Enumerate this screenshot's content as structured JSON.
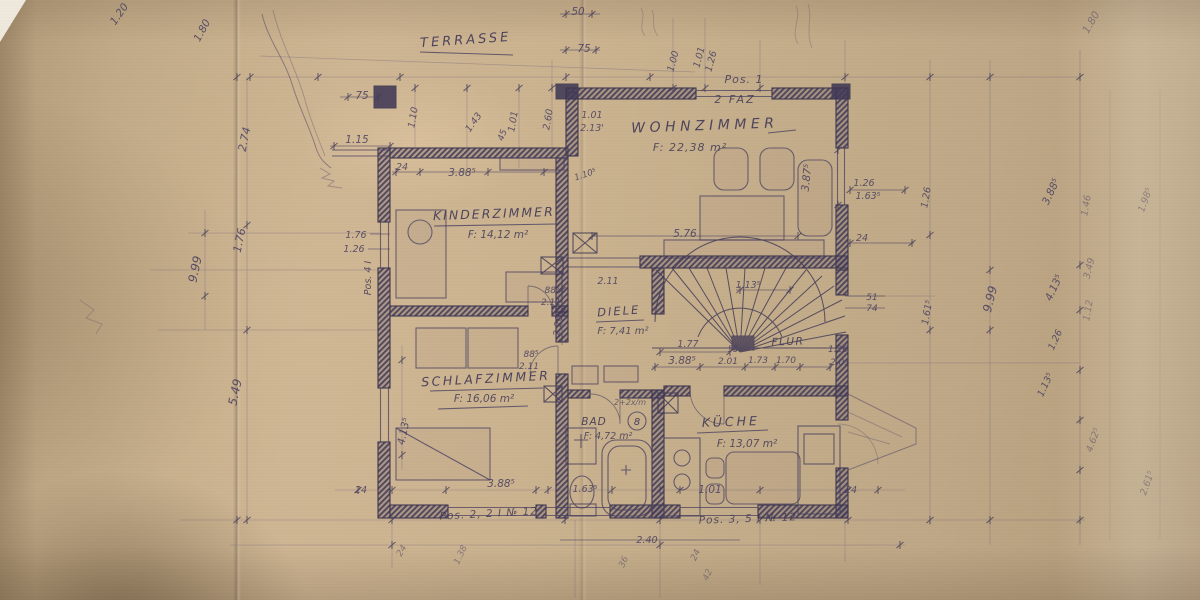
{
  "colors": {
    "paper": "#c8b190",
    "ink": "#4a4160",
    "pencil": "#6d5f80"
  },
  "rooms": {
    "terrasse": {
      "label": "TERRASSE"
    },
    "wohnzimmer": {
      "label": "WOHNZIMMER",
      "area": "F: 22,38 m²"
    },
    "kinderzimmer": {
      "label": "KINDERZIMMER",
      "area": "F: 14,12 m²"
    },
    "schlafzimmer": {
      "label": "SCHLAFZIMMER",
      "area": "F: 16,06 m²"
    },
    "diele": {
      "label": "DIELE",
      "area": "F: 7,41 m²"
    },
    "flur": {
      "label": "FLUR"
    },
    "bad": {
      "label": "BAD",
      "area": "F: 4,72 m²"
    },
    "kueche": {
      "label": "KÜCHE",
      "area": "F: 13,07 m²"
    }
  },
  "badges": {
    "bad_circle": "8"
  },
  "annotations": [
    {
      "t": "Pos. 1",
      "x": 744,
      "y": 83,
      "s": 11,
      "w": 1,
      "cls": "note"
    },
    {
      "t": "2 FAZ",
      "x": 735,
      "y": 103,
      "s": 11,
      "w": 2,
      "cls": "note"
    },
    {
      "t": "Pos. 2, 2 I № 12",
      "x": 489,
      "y": 517,
      "s": 10.5,
      "w": 1,
      "r": -3,
      "cls": "note"
    },
    {
      "t": "Pos. 3, 5 I № 12",
      "x": 748,
      "y": 522,
      "s": 10.5,
      "w": 1,
      "r": -2,
      "cls": "note"
    },
    {
      "t": "Pos. 4 I",
      "x": 371,
      "y": 278,
      "r": -90,
      "s": 9.5,
      "cls": "note"
    },
    {
      "t": "2+2x/m",
      "x": 630,
      "y": 405,
      "s": 8,
      "o": 0.7,
      "cls": "note"
    },
    {
      "t": "1.20",
      "x": 122,
      "y": 16,
      "r": -55
    },
    {
      "t": "1.80",
      "x": 205,
      "y": 32,
      "r": -62
    },
    {
      "t": "50",
      "x": 578,
      "y": 15
    },
    {
      "t": "75",
      "x": 584,
      "y": 52
    },
    {
      "t": "75",
      "x": 362,
      "y": 99
    },
    {
      "t": "1.15",
      "x": 357,
      "y": 143
    },
    {
      "t": "1.00",
      "x": 676,
      "y": 62,
      "r": -75,
      "s": 9.5
    },
    {
      "t": "1.01",
      "x": 702,
      "y": 58,
      "r": -75,
      "s": 9.5
    },
    {
      "t": "1.26",
      "x": 714,
      "y": 62,
      "r": -75,
      "s": 9.5
    },
    {
      "t": "24",
      "x": 402,
      "y": 170,
      "s": 9.5
    },
    {
      "t": "3.88⁵",
      "x": 462,
      "y": 176
    },
    {
      "t": "1.10",
      "x": 416,
      "y": 118,
      "r": -80,
      "s": 9.5
    },
    {
      "t": "1.43",
      "x": 476,
      "y": 124,
      "r": -55,
      "s": 9.5
    },
    {
      "t": "45",
      "x": 505,
      "y": 136,
      "r": -70,
      "s": 9
    },
    {
      "t": "1.01",
      "x": 516,
      "y": 122,
      "r": -80,
      "s": 9.5
    },
    {
      "t": "2.60",
      "x": 551,
      "y": 120,
      "r": -80,
      "s": 9.5
    },
    {
      "t": "1.01",
      "x": 592,
      "y": 118,
      "s": 9.5
    },
    {
      "t": "2.13'",
      "x": 592,
      "y": 131,
      "s": 9.5
    },
    {
      "t": "1.10⁵",
      "x": 586,
      "y": 177,
      "r": -18,
      "s": 8.5
    },
    {
      "t": "5.76",
      "x": 685,
      "y": 237
    },
    {
      "t": "3.87⁵",
      "x": 810,
      "y": 178,
      "r": -84
    },
    {
      "t": "1.26",
      "x": 864,
      "y": 186,
      "s": 9.5
    },
    {
      "t": "1.63⁵",
      "x": 868,
      "y": 199,
      "s": 9.5
    },
    {
      "t": "24",
      "x": 862,
      "y": 241,
      "s": 9.5
    },
    {
      "t": "1.26",
      "x": 929,
      "y": 198,
      "r": -80,
      "s": 9.5
    },
    {
      "t": "1.61⁵",
      "x": 930,
      "y": 313,
      "r": -80,
      "s": 9.5
    },
    {
      "t": "51",
      "x": 872,
      "y": 300,
      "s": 9
    },
    {
      "t": "74",
      "x": 872,
      "y": 311,
      "s": 9
    },
    {
      "t": "9.99",
      "x": 994,
      "y": 300,
      "r": -76,
      "s": 12
    },
    {
      "t": "3.88⁵",
      "x": 1054,
      "y": 193,
      "r": -65
    },
    {
      "t": "4.13⁵",
      "x": 1057,
      "y": 289,
      "r": -65
    },
    {
      "t": "1.26",
      "x": 1058,
      "y": 341,
      "r": -65,
      "s": 9.5
    },
    {
      "t": "1.13⁵",
      "x": 1048,
      "y": 386,
      "r": -65,
      "s": 9.5
    },
    {
      "t": "1.80",
      "x": 1094,
      "y": 24,
      "r": -60,
      "o": 0.5
    },
    {
      "t": "1.46",
      "x": 1089,
      "y": 206,
      "r": -80,
      "o": 0.5,
      "s": 9.5
    },
    {
      "t": "1.98⁵",
      "x": 1148,
      "y": 201,
      "r": -70,
      "o": 0.45,
      "s": 9.5
    },
    {
      "t": "3.49",
      "x": 1092,
      "y": 269,
      "r": -76,
      "o": 0.5,
      "s": 9.5
    },
    {
      "t": "1.12",
      "x": 1091,
      "y": 311,
      "r": -80,
      "o": 0.45,
      "s": 9.5
    },
    {
      "t": "4.62⁵",
      "x": 1096,
      "y": 441,
      "r": -70,
      "o": 0.5,
      "s": 9.5
    },
    {
      "t": "2.61⁵",
      "x": 1150,
      "y": 484,
      "r": -70,
      "o": 0.45,
      "s": 9.5
    },
    {
      "t": "2.74",
      "x": 248,
      "y": 140,
      "r": -78,
      "s": 11
    },
    {
      "t": "1.76",
      "x": 243,
      "y": 241,
      "r": -78,
      "s": 11
    },
    {
      "t": "9.99",
      "x": 199,
      "y": 270,
      "r": -78,
      "s": 12
    },
    {
      "t": "5.49",
      "x": 239,
      "y": 393,
      "r": -78,
      "s": 12
    },
    {
      "t": "1.76",
      "x": 356,
      "y": 238,
      "s": 9.5
    },
    {
      "t": "1.26",
      "x": 354,
      "y": 252,
      "s": 9.5
    },
    {
      "t": "4.13⁵",
      "x": 407,
      "y": 432,
      "r": -78
    },
    {
      "t": "2.11",
      "x": 608,
      "y": 284,
      "s": 9.5
    },
    {
      "t": "88⁵",
      "x": 552,
      "y": 293,
      "s": 9
    },
    {
      "t": "2.11",
      "x": 551,
      "y": 305,
      "s": 9
    },
    {
      "t": "2.26",
      "x": 561,
      "y": 326,
      "r": -84,
      "s": 9.5
    },
    {
      "t": "1.13⁵",
      "x": 748,
      "y": 288,
      "s": 9.5
    },
    {
      "t": "1.77",
      "x": 688,
      "y": 347,
      "s": 9.5
    },
    {
      "t": "55",
      "x": 733,
      "y": 352,
      "s": 8.5
    },
    {
      "t": "3.88⁵",
      "x": 682,
      "y": 364
    },
    {
      "t": "2.01",
      "x": 728,
      "y": 364,
      "s": 9
    },
    {
      "t": "1.73",
      "x": 758,
      "y": 363,
      "s": 9
    },
    {
      "t": "1.70",
      "x": 786,
      "y": 363,
      "s": 9
    },
    {
      "t": "1.26",
      "x": 838,
      "y": 352,
      "s": 9
    },
    {
      "t": "2.01",
      "x": 840,
      "y": 365,
      "s": 9
    },
    {
      "t": "88⁵",
      "x": 531,
      "y": 357,
      "s": 9
    },
    {
      "t": "2.11",
      "x": 529,
      "y": 369,
      "s": 9
    },
    {
      "t": "1.01",
      "x": 710,
      "y": 493
    },
    {
      "t": "24",
      "x": 851,
      "y": 493,
      "s": 9.5
    },
    {
      "t": "24",
      "x": 361,
      "y": 493,
      "s": 9.5
    },
    {
      "t": "3.88⁵",
      "x": 501,
      "y": 487
    },
    {
      "t": "1.63⁵",
      "x": 585,
      "y": 492,
      "s": 9.5
    },
    {
      "t": "2.40",
      "x": 647,
      "y": 543,
      "s": 9.5
    },
    {
      "t": "24",
      "x": 404,
      "y": 552,
      "r": -60,
      "o": 0.55,
      "s": 9
    },
    {
      "t": "1.38",
      "x": 463,
      "y": 556,
      "r": -65,
      "o": 0.5,
      "s": 9
    },
    {
      "t": "36",
      "x": 626,
      "y": 563,
      "r": -65,
      "o": 0.5,
      "s": 9
    },
    {
      "t": "24",
      "x": 698,
      "y": 556,
      "r": -65,
      "o": 0.55,
      "s": 9
    },
    {
      "t": "42",
      "x": 710,
      "y": 576,
      "r": -65,
      "o": 0.45,
      "s": 9
    }
  ]
}
